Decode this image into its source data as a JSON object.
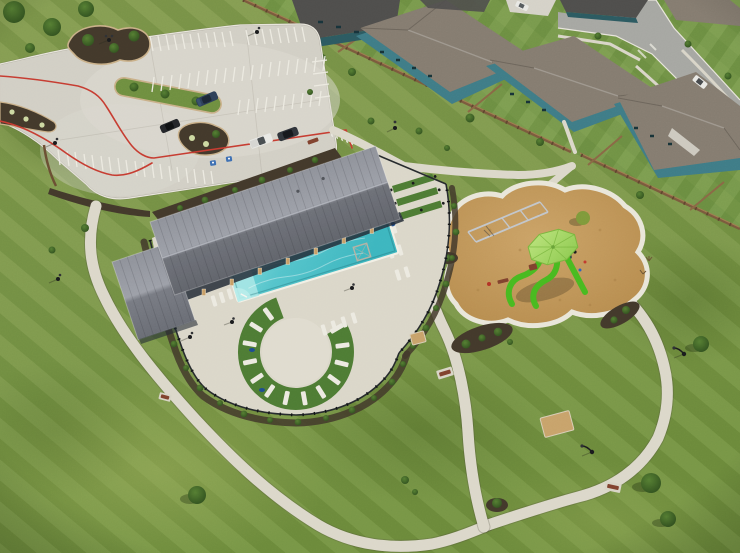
{
  "image": {
    "type": "aerial drone photograph",
    "subject": "Aerial view of a residential community amenity center with pool pavilion, playground, parking lot and curving walking paths",
    "width": 740,
    "height": 553
  },
  "palette": {
    "grass": "#7a9647",
    "grassLight": "#97ae5b",
    "grassDark": "#5d7930",
    "backyard": "#6f9844",
    "turf": "#4e7c34",
    "concretePath": "#dcd8ca",
    "concreteLot": "#d2cfc5",
    "concreteBright": "#e4e1d6",
    "deckConcrete": "#dbd7c9",
    "asphalt": "#a6a7a2",
    "curb": "#e8e5dc",
    "roofMetal": "#83868e",
    "roofMetalDark": "#6a6d75",
    "roofRidge": "#b6b9c1",
    "shingle": "#857c70",
    "roofDarkHouse": "#4f4e4c",
    "houseTeal": "#3f7c87",
    "houseTealDark": "#2c5a61",
    "fenceWood": "#7b5a3d",
    "fenceWoodLight": "#a07b50",
    "fenceBlack": "#262a2d",
    "poolWater": "#55c4cb",
    "poolWaterLight": "#a9e8e6",
    "poolWaterDeep": "#2fa8b4",
    "mulchPlay": "#c09556",
    "mulchBed": "#43392b",
    "fireLaneRed": "#c63c31",
    "stripeWhite": "#eceae1",
    "limeUmbrella": "#a4d961",
    "limeUmbrellaDark": "#86c04a",
    "slideGreen": "#49ba20",
    "navyUmbrella": "#1d4d8f",
    "benchBrown": "#81422e",
    "carNavy": "#2e4059",
    "carBlack": "#24262a",
    "carWhite": "#e9e9e5",
    "poleBlack": "#1a1b1d",
    "tanPad": "#c8a36b",
    "wallShadow": "#232c36",
    "treeGreen": "#3c5f27",
    "treeGreenLight": "#567f33"
  },
  "features": {
    "parking_lot": {
      "surface": "concrete",
      "fire_lane_markings": "red painted lines",
      "parked_cars": 4,
      "handicap_markings": 2,
      "bike_rack_loops": 5,
      "landscape_islands": 3
    },
    "pavilion": {
      "roof": "gray standing-seam metal",
      "structure": "open-air pavilion with wood columns on stone bases"
    },
    "pool": {
      "shape": "rectangular",
      "water_color": "turquoise",
      "lounge_chairs": 31,
      "closed_navy_umbrellas": 5,
      "enclosure": "black metal fence",
      "round_lounge_deck_with_turf_ring": true
    },
    "playground": {
      "surface": "tan engineered wood mulch",
      "shade_umbrella_color": "lime green",
      "slides": 3,
      "swing_set": true,
      "benches": 2
    },
    "paths": {
      "material": "light concrete",
      "layout": "curving loop through lawn connecting parking, pool, playground and neighborhood"
    },
    "neighborhood": {
      "houses_visible": 7,
      "siding_color": "teal",
      "roofs": "gray-brown shingle",
      "privacy_fence": "brown wood",
      "cars_on_street_and_driveway": 2
    },
    "site_furniture": {
      "park_benches": 4,
      "light_poles": 8,
      "crushed_granite_pads": 2
    }
  }
}
